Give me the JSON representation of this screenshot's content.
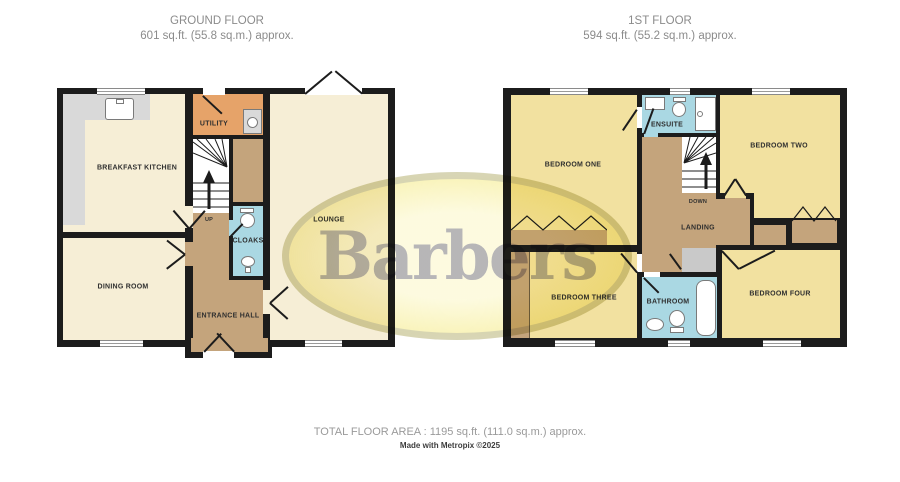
{
  "titles": {
    "ground": {
      "line1": "GROUND FLOOR",
      "line2": "601 sq.ft. (55.8 sq.m.) approx."
    },
    "first": {
      "line1": "1ST FLOOR",
      "line2": "594 sq.ft. (55.2 sq.m.) approx."
    }
  },
  "ground": {
    "breakfast_kitchen": "BREAKFAST KITCHEN",
    "utility": "UTILITY",
    "up": "UP",
    "cloaks": "CLOAKS",
    "lounge": "LOUNGE",
    "dining_room": "DINING ROOM",
    "entrance_hall": "ENTRANCE HALL"
  },
  "first": {
    "bedroom_one": "BEDROOM ONE",
    "ensuite": "ENSUITE",
    "down": "DOWN",
    "bedroom_two": "BEDROOM TWO",
    "landing": "LANDING",
    "bedroom_three": "BEDROOM THREE",
    "bathroom": "BATHROOM",
    "bedroom_four": "BEDROOM FOUR"
  },
  "watermark": {
    "text": "Barbers"
  },
  "footer": {
    "total_area": "TOTAL FLOOR AREA : 1195 sq.ft. (111.0 sq.m.) approx.",
    "credit": "Made with Metropix ©2025"
  },
  "colors": {
    "wall": "#1c1c1c",
    "cream": "#f6eed6",
    "bedroom_yellow": "#f2e1a0",
    "hall_tan": "#c4a47c",
    "utility_orange": "#e6a369",
    "bath_blue": "#aad8e3",
    "counter_gray": "#d9d9d9",
    "cupboard_gray": "#c9c9c9",
    "watermark_fill": "#f0e25a",
    "watermark_text": "#b9b9d2"
  }
}
